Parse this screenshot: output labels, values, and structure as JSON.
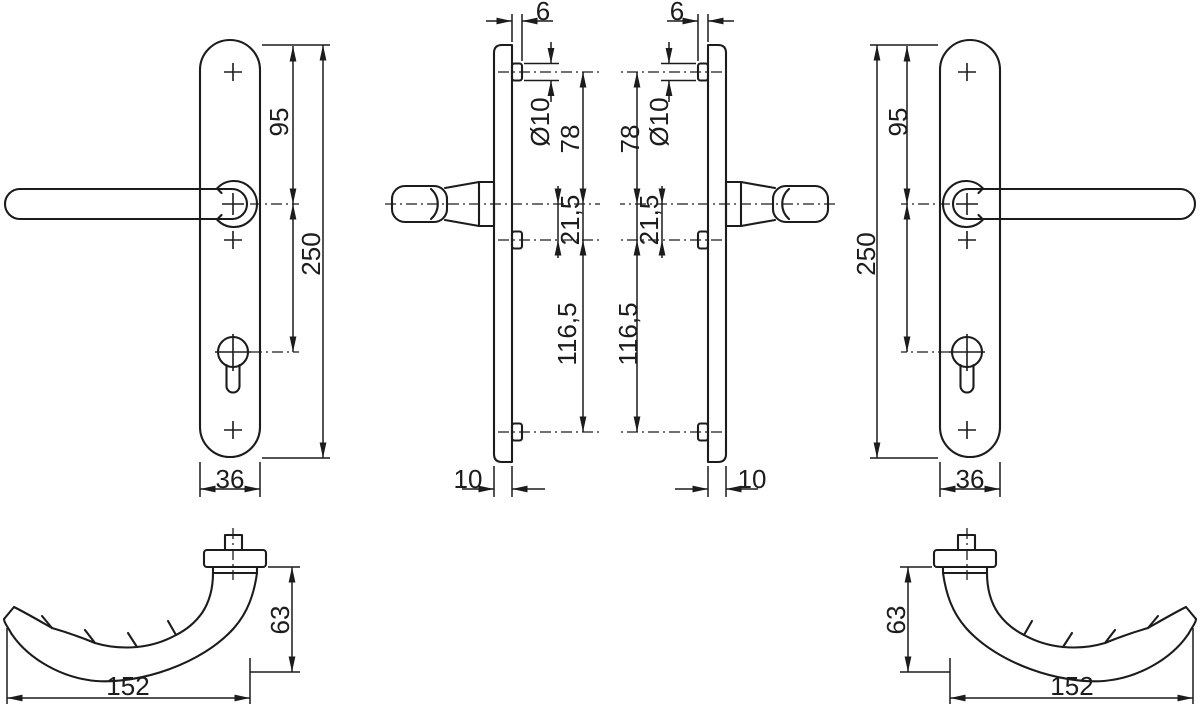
{
  "drawing": {
    "type": "technical-dimension-drawing",
    "subject": "door-handle-set-with-narrow-backplate",
    "colors": {
      "line": "#1c1c1c",
      "background": "#ffffff"
    },
    "views": {
      "front_left": {
        "handle_to_top": "95",
        "plate_length": "250",
        "plate_width": "36"
      },
      "side_left": {
        "boss_protrusion": "6",
        "boss_diameter": "Ø10",
        "top_to_handle": "78",
        "handle_to_mid": "21,5",
        "mid_to_bottom": "116,5",
        "plate_thickness": "10"
      },
      "side_right": {
        "boss_protrusion": "6",
        "boss_diameter": "Ø10",
        "top_to_handle": "78",
        "handle_to_mid": "21,5",
        "mid_to_bottom": "116,5",
        "plate_thickness": "10"
      },
      "front_right": {
        "handle_to_top": "95",
        "plate_length": "250",
        "plate_width": "36"
      },
      "bottom_left": {
        "handle_projection": "63",
        "handle_length": "152"
      },
      "bottom_right": {
        "handle_projection": "63",
        "handle_length": "152"
      }
    }
  }
}
